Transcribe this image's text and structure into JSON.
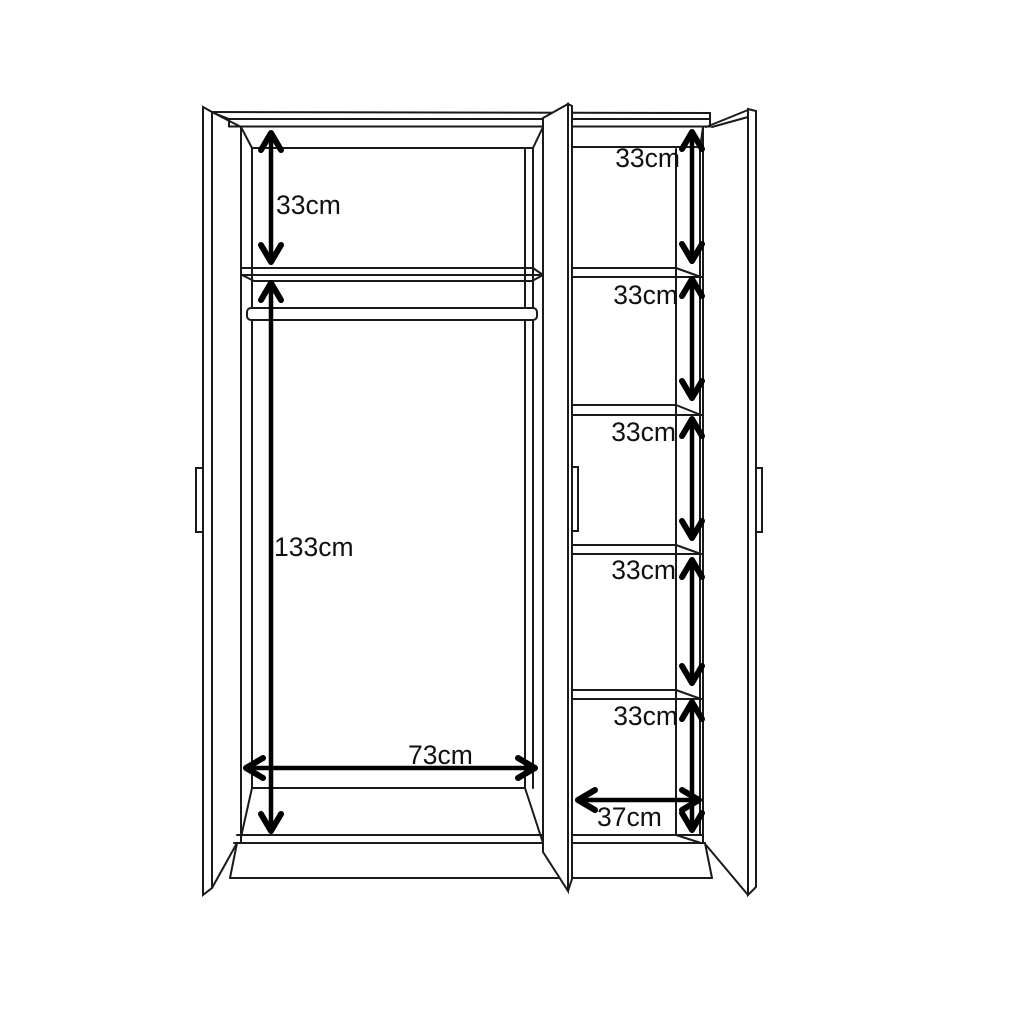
{
  "diagram": {
    "type": "wardrobe-dimension-diagram",
    "background_color": "#ffffff",
    "line_color": "#1a1a1a",
    "unit": "cm",
    "left_section": {
      "top_shelf_height": "33cm",
      "hanging_height": "133cm",
      "interior_width": "73cm"
    },
    "right_section": {
      "shelf_heights": [
        "33cm",
        "33cm",
        "33cm",
        "33cm",
        "33cm"
      ],
      "interior_width": "37cm"
    }
  }
}
